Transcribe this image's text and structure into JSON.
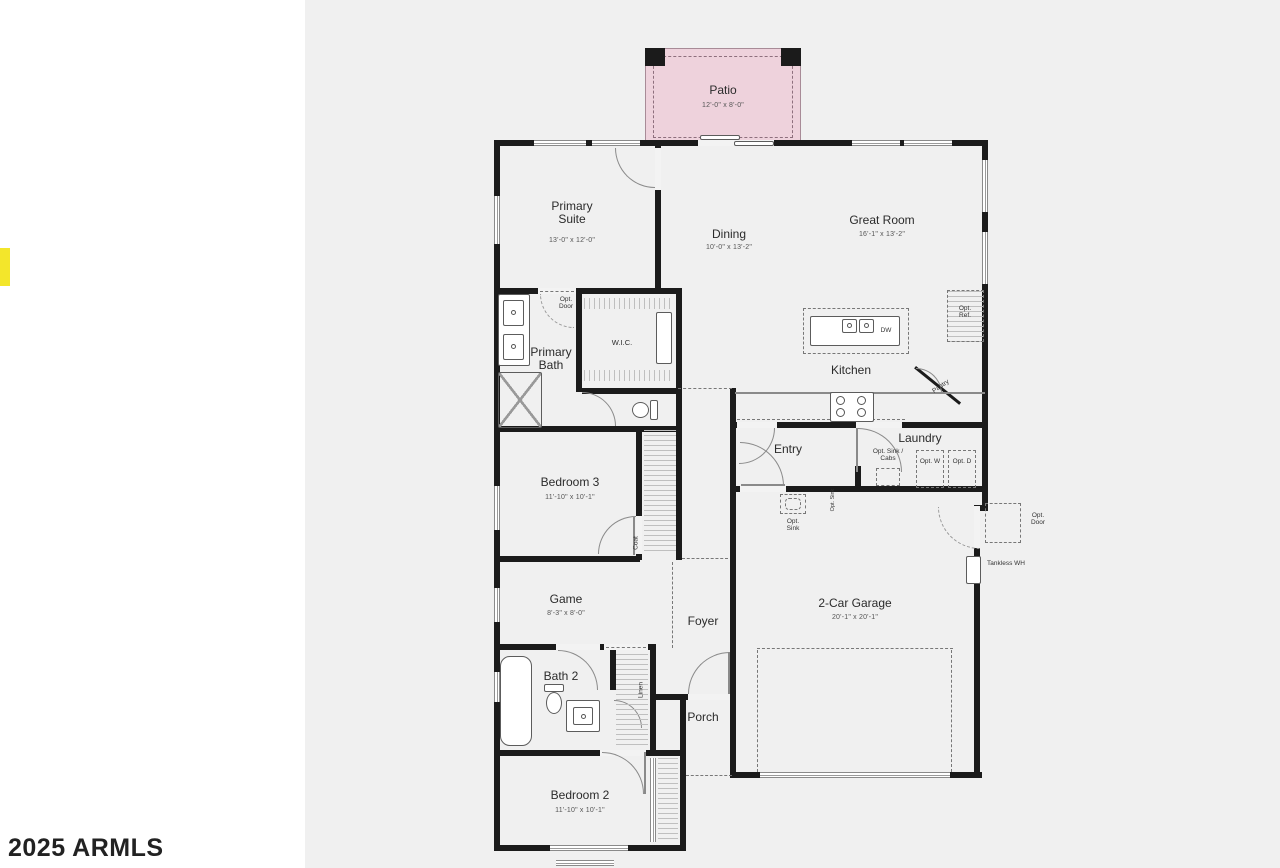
{
  "watermark": "2025 ARMLS",
  "colors": {
    "plan_background": "#f0f0f0",
    "wall": "#1b1b1b",
    "patio_fill": "#eed2dc",
    "highlight_marker": "#f3e62b"
  },
  "rooms": {
    "patio": {
      "label": "Patio",
      "dims": "12'-0\" x 8'-0\""
    },
    "primary_suite": {
      "label": "Primary Suite",
      "dims": "13'-0\" x 12'-0\""
    },
    "dining": {
      "label": "Dining",
      "dims": "10'-0\" x 13'-2\""
    },
    "great_room": {
      "label": "Great Room",
      "dims": "16'-1\" x 13'-2\""
    },
    "kitchen": {
      "label": "Kitchen"
    },
    "primary_bath": {
      "label": "Primary Bath"
    },
    "wic": {
      "label": "W.I.C."
    },
    "bedroom3": {
      "label": "Bedroom 3",
      "dims": "11'-10\" x 10'-1\""
    },
    "game": {
      "label": "Game",
      "dims": "8'-3\" x 8'-0\""
    },
    "foyer": {
      "label": "Foyer"
    },
    "entry": {
      "label": "Entry"
    },
    "laundry": {
      "label": "Laundry"
    },
    "garage": {
      "label": "2-Car Garage",
      "dims": "20'-1\" x 20'-1\""
    },
    "porch": {
      "label": "Porch"
    },
    "bath2": {
      "label": "Bath 2"
    },
    "bedroom2": {
      "label": "Bedroom 2",
      "dims": "11'-10\" x 10'-1\""
    }
  },
  "annotations": {
    "opt_door_bath": "Opt. Door",
    "dw": "DW",
    "pantry": "Pantry",
    "opt_ref": "Opt. Ref.",
    "opt_sink_cabs": "Opt. Sink / Cabs",
    "opt_w": "Opt. W",
    "opt_d": "Opt. D",
    "opt_sink": "Opt. Sink",
    "opt_sink_wall": "Opt. Sink",
    "coat": "Coat",
    "linen": "Linen",
    "tankless_wh": "Tankless WH",
    "opt_door_garage": "Opt. Door"
  }
}
